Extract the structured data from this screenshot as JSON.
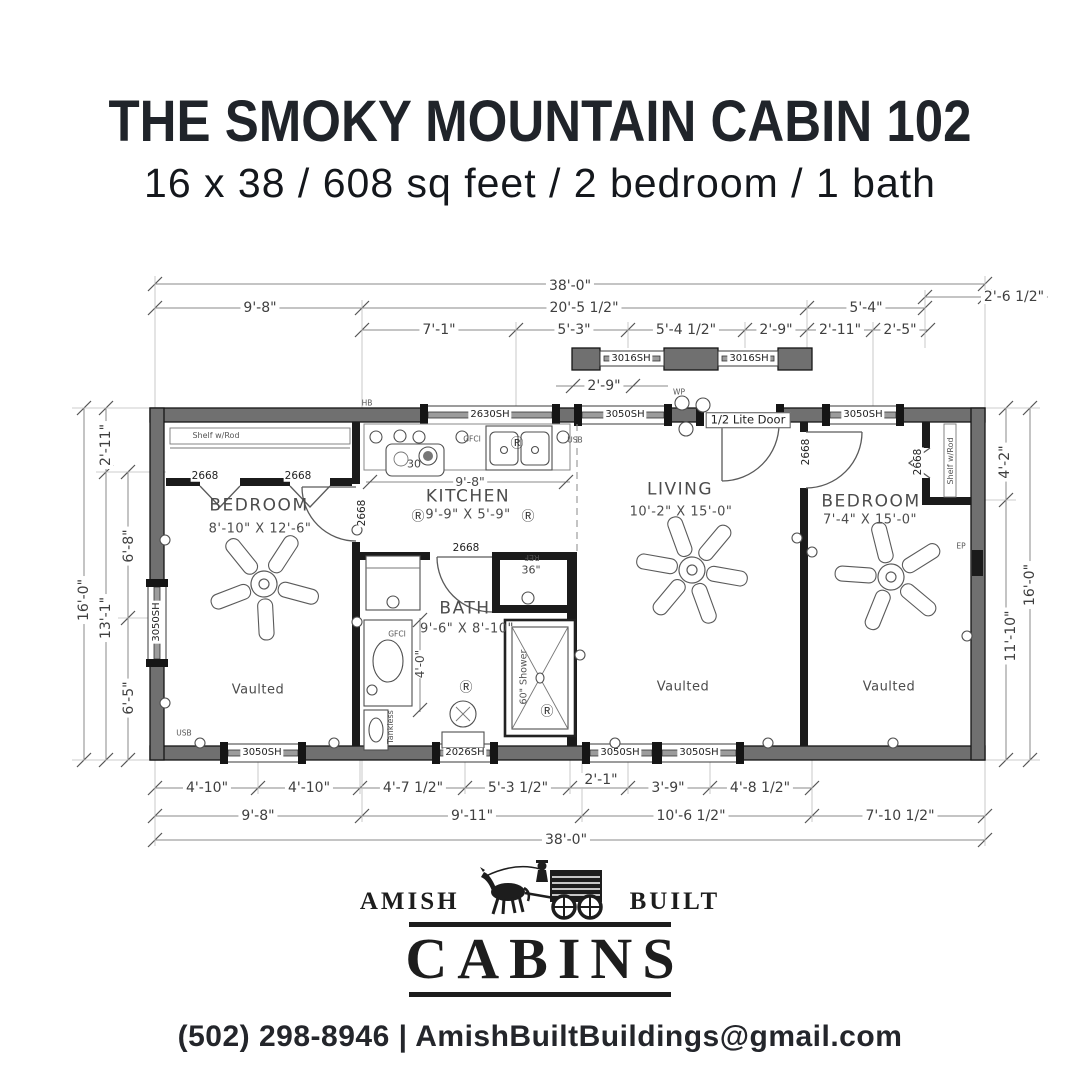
{
  "header": {
    "title": "THE SMOKY MOUNTAIN CABIN 102",
    "subtitle": "16 x 38 / 608 sq feet / 2 bedroom / 1 bath"
  },
  "plan": {
    "dims": {
      "top": [
        "38'-0\"",
        "9'-8\"",
        "20'-5 1/2\"",
        "5'-4\"",
        "2'-6 1/2\"",
        "7'-1\"",
        "5'-3\"",
        "5'-4 1/2\"",
        "2'-9\"",
        "2'-11\"",
        "2'-5\"",
        "2'-9\""
      ],
      "bottom": [
        "4'-10\"",
        "4'-10\"",
        "4'-7 1/2\"",
        "5'-3 1/2\"",
        "2'-1\"",
        "3'-9\"",
        "4'-8 1/2\"",
        "9'-8\"",
        "9'-11\"",
        "10'-6 1/2\"",
        "7'-10 1/2\"",
        "38'-0\""
      ],
      "left": [
        "16'-0\"",
        "2'-11\"",
        "13'-1\"",
        "6'-8\"",
        "6'-5\""
      ],
      "right": [
        "4'-2\"",
        "11'-10\"",
        "16'-0\""
      ],
      "kitchen_width": "9'-8\"",
      "bath_clearance": "4'-0\""
    },
    "rooms": {
      "bedroom_left": {
        "name": "BEDROOM",
        "size": "8'-10\" X 12'-6\""
      },
      "kitchen": {
        "name": "KITCHEN",
        "size": "9'-9\" X 5'-9\""
      },
      "living": {
        "name": "LIVING",
        "size": "10'-2\" X 15'-0\""
      },
      "bath": {
        "name": "BATH",
        "size": "9'-6\" X 8'-10\""
      },
      "bedroom_right": {
        "name": "BEDROOM",
        "size": "7'-4\" X 15'-0\""
      }
    },
    "openings": {
      "window_2630sh": "2630SH",
      "window_3050sh": "3050SH",
      "window_3016sh": "3016SH",
      "window_2026sh": "2026SH",
      "door_2668": "2668",
      "front_door": "1/2 Lite Door"
    },
    "labels": {
      "shelf_rod": "Shelf w/Rod",
      "vaulted": "Vaulted",
      "ref": "REF",
      "ref_width": "36\"",
      "shower": "60\" Shower",
      "range_width": "30",
      "tankless": "Tankless",
      "gfci": "GFCI",
      "usb": "USB",
      "receptacle_symbol": "Ⓡ",
      "hose_bib": "HB",
      "weatherproof": "WP",
      "electrical_panel": "EP"
    }
  },
  "logo": {
    "word_left": "AMISH",
    "word_right": "BUILT",
    "brand": "CABINS"
  },
  "footer": {
    "phone": "(502) 298-8946",
    "divider": "|",
    "email": "AmishBuiltBuildings@gmail.com"
  }
}
